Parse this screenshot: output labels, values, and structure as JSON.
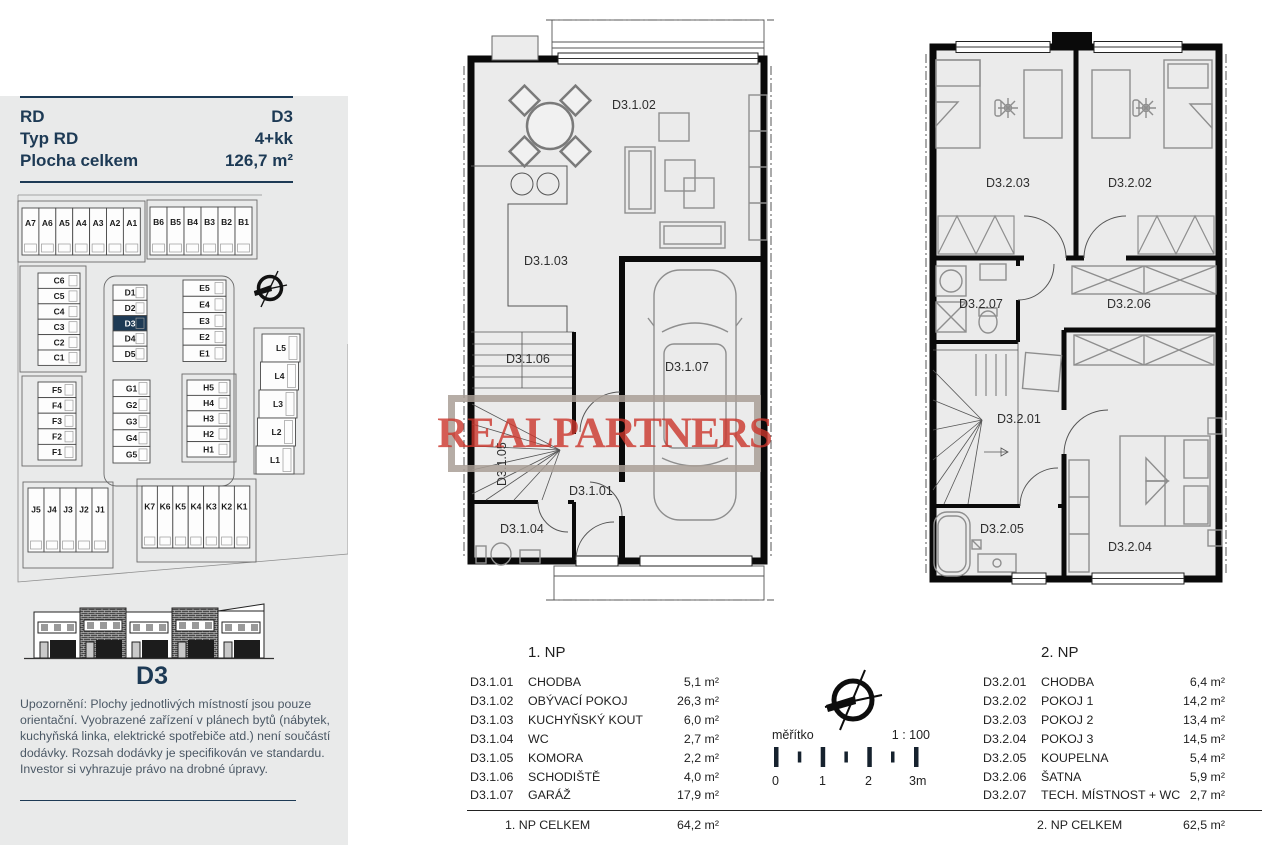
{
  "panel": {
    "specs": [
      {
        "label": "RD",
        "value": "D3"
      },
      {
        "label": "Typ RD",
        "value": "4+kk"
      },
      {
        "label": "Plocha celkem",
        "value": "126,7 m²"
      }
    ],
    "caption": "D3",
    "disclaimer": "Upozornění: Plochy jednotlivých místností jsou pouze orientační. Vyobrazené zařízení v plánech bytů (nábytek, kuchyňská linka, elektrické spotřebiče atd.) není součástí dodávky. Rozsah dodávky je specifikován ve standardu. Investor si vyhrazuje právo na drobné úpravy."
  },
  "site": {
    "highlight": "D3",
    "lots": {
      "a": [
        "A7",
        "A6",
        "A5",
        "A4",
        "A3",
        "A2",
        "A1"
      ],
      "b": [
        "B6",
        "B5",
        "B4",
        "B3",
        "B2",
        "B1"
      ],
      "c": [
        "C6",
        "C5",
        "C4",
        "C3",
        "C2",
        "C1"
      ],
      "d": [
        "D1",
        "D2",
        "D3",
        "D4",
        "D5"
      ],
      "e": [
        "E5",
        "E4",
        "E3",
        "E2",
        "E1"
      ],
      "f": [
        "F5",
        "F4",
        "F3",
        "F2",
        "F1"
      ],
      "g": [
        "G1",
        "G2",
        "G3",
        "G4",
        "G5"
      ],
      "h": [
        "H5",
        "H4",
        "H3",
        "H2",
        "H1"
      ],
      "l": [
        "L5",
        "L4",
        "L3",
        "L2",
        "L1"
      ],
      "j": [
        "J5",
        "J4",
        "J3",
        "J2",
        "J1"
      ],
      "k": [
        "K7",
        "K6",
        "K5",
        "K4",
        "K3",
        "K2",
        "K1"
      ]
    }
  },
  "plan1": {
    "rooms": {
      "r01": "D3.1.01",
      "r02": "D3.1.02",
      "r03": "D3.1.03",
      "r04": "D3.1.04",
      "r05": "D3.1.05",
      "r06": "D3.1.06",
      "r07": "D3.1.07"
    }
  },
  "plan2": {
    "rooms": {
      "r01": "D3.2.01",
      "r02": "D3.2.02",
      "r03": "D3.2.03",
      "r04": "D3.2.04",
      "r05": "D3.2.05",
      "r06": "D3.2.06",
      "r07": "D3.2.07"
    }
  },
  "legend1": {
    "title": "1. NP",
    "rows": [
      {
        "code": "D3.1.01",
        "name": "CHODBA",
        "area": "5,1 m²"
      },
      {
        "code": "D3.1.02",
        "name": "OBÝVACÍ POKOJ",
        "area": "26,3 m²"
      },
      {
        "code": "D3.1.03",
        "name": "KUCHYŇSKÝ KOUT",
        "area": "6,0 m²"
      },
      {
        "code": "D3.1.04",
        "name": "WC",
        "area": "2,7 m²"
      },
      {
        "code": "D3.1.05",
        "name": "KOMORA",
        "area": "2,2 m²"
      },
      {
        "code": "D3.1.06",
        "name": "SCHODIŠTĚ",
        "area": "4,0 m²"
      },
      {
        "code": "D3.1.07",
        "name": "GARÁŽ",
        "area": "17,9 m²"
      }
    ],
    "total_label": "1. NP CELKEM",
    "total_area": "64,2 m²"
  },
  "legend2": {
    "title": "2. NP",
    "rows": [
      {
        "code": "D3.2.01",
        "name": "CHODBA",
        "area": "6,4 m²"
      },
      {
        "code": "D3.2.02",
        "name": "POKOJ 1",
        "area": "14,2 m²"
      },
      {
        "code": "D3.2.03",
        "name": "POKOJ 2",
        "area": "13,4 m²"
      },
      {
        "code": "D3.2.04",
        "name": "POKOJ 3",
        "area": "14,5 m²"
      },
      {
        "code": "D3.2.05",
        "name": "KOUPELNA",
        "area": "5,4 m²"
      },
      {
        "code": "D3.2.06",
        "name": "ŠATNA",
        "area": "5,9 m²"
      },
      {
        "code": "D3.2.07",
        "name": "TECH. MÍSTNOST + WC",
        "area": "2,7 m²"
      }
    ],
    "total_label": "2. NP CELKEM",
    "total_area": "62,5 m²"
  },
  "scale": {
    "label": "měřítko",
    "ratio": "1 : 100",
    "ticks": [
      "0",
      "1",
      "2",
      "3m"
    ]
  },
  "watermark": {
    "text": "REALPARTNERS"
  },
  "colors": {
    "navy": "#1d3a55",
    "panel_bg": "#e9eaea",
    "floor": "#ebebeb",
    "wall": "#0a0a0a",
    "furniture": "#8e8e8e",
    "watermark_red": "#cb342b",
    "watermark_frame": "#a99f97"
  }
}
